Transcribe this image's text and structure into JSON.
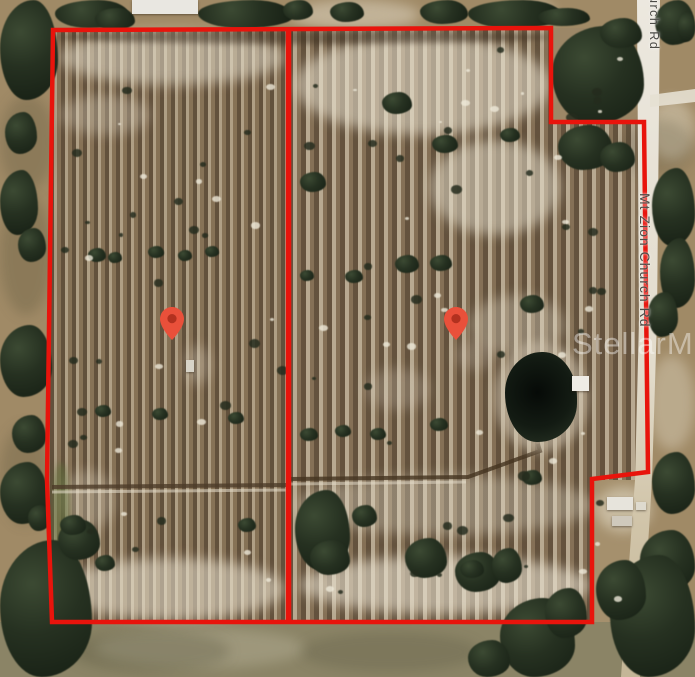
{
  "map": {
    "watermark_text": "StellarMLS",
    "roads": {
      "top_label": "urch Rd",
      "middle_label": "Mt Zion Church Rd"
    },
    "parcel": {
      "boundary_color": "#e8140c",
      "marker_color": "#e9503a",
      "marker_inner_color": "#b2311f",
      "marker_count": 2
    }
  }
}
